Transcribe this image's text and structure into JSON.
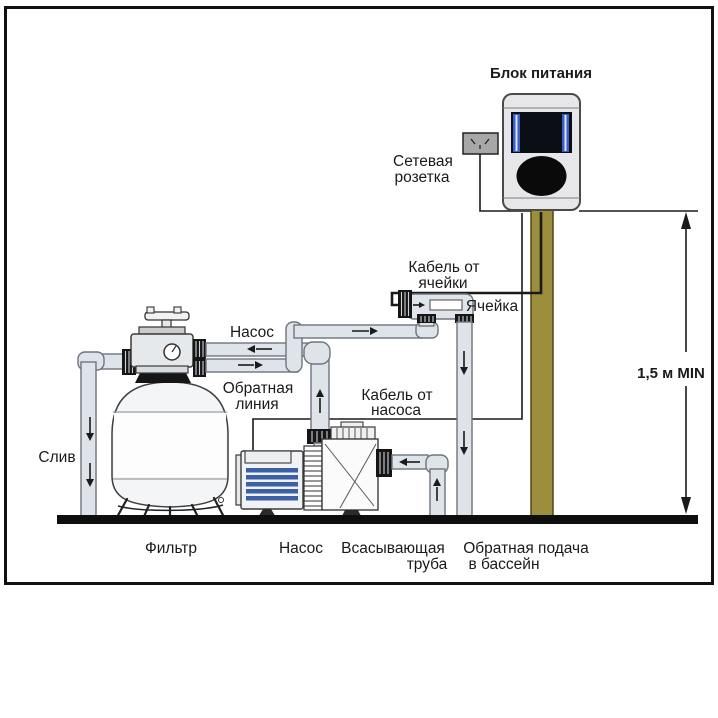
{
  "labels": {
    "power_supply": "Блок питания",
    "socket_l1": "Сетевая",
    "socket_l2": "розетка",
    "cell_cable_l1": "Кабель от",
    "cell_cable_l2": "ячейки",
    "cell": "Ячейка",
    "pump_line": "Насос",
    "return_l1": "Обратная",
    "return_l2": "линия",
    "pump_cable_l1": "Кабель от",
    "pump_cable_l2": "насоса",
    "drain": "Слив",
    "min_height": "1,5 м MIN",
    "filter": "Фильтр",
    "pump": "Насос",
    "suction_l1": "Всасывающая",
    "suction_l2": "труба",
    "pool_return_l1": "Обратная подача",
    "pool_return_l2": "в бассейн"
  },
  "colors": {
    "pipe_fill": "#dfe4ea",
    "pipe_stroke": "#6f757d",
    "machine_stroke": "#3f3f3f",
    "pole_fill": "#9b8e3c",
    "pole_stroke": "#4e4618",
    "motor_stripe": "#3d5fa8",
    "screen_bar": "#3a5ec6",
    "psu_fill": "#e7e7e9",
    "ground": "#0e0e0e",
    "ink": "#1a1a1a"
  }
}
